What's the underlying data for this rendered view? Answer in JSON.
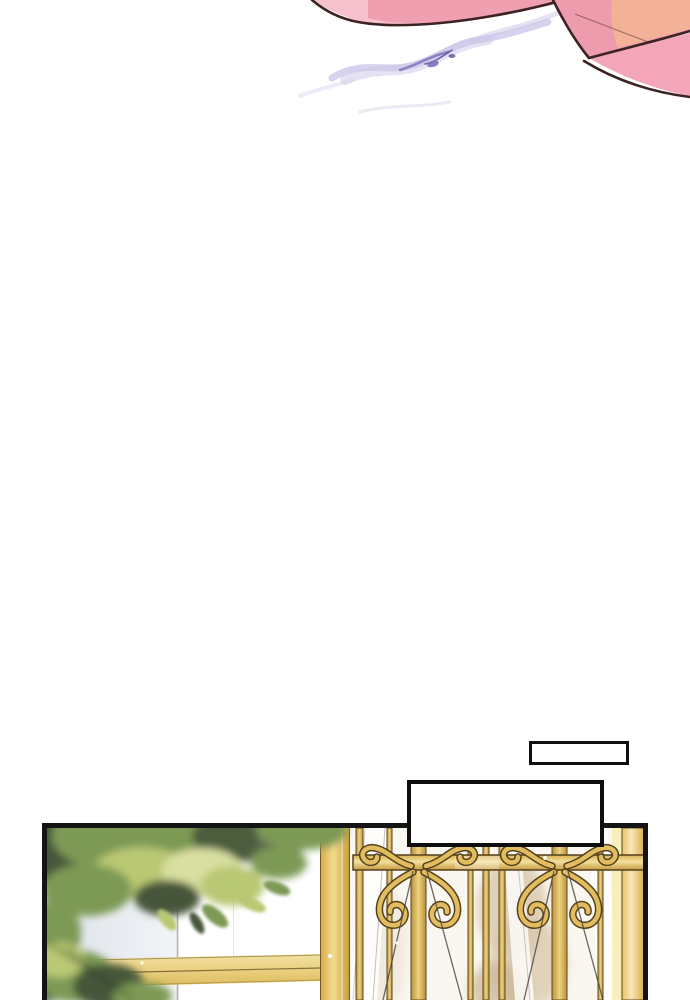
{
  "page": {
    "background": "#ffffff",
    "kind": "comic-page"
  },
  "palette": {
    "box_border": "#0e0e0e",
    "panel_border": "#141414",
    "outline_dark": "#3a2322",
    "ribbon_light": "#f7c0cd",
    "ribbon_rose": "#ee9bad",
    "ribbon_salmon": "#f2b397",
    "ribbon_band": "#f2a6b8",
    "smoke_light": "#cdc5ea",
    "smoke_mid": "#a79bd6",
    "smoke_dark": "#7a6bb4",
    "wall_blue": "#dde3ea",
    "leaf_dark": "#46573a",
    "leaf_mid": "#7d9a55",
    "leaf_light": "#b9c873",
    "leaf_pale": "#d9dfa0",
    "gold_mid": "#e2bd5f",
    "gold_line": "#5d4720",
    "marble": "#d8c6aa",
    "drape_line": "#b5afa6",
    "cord_dark": "#4a4238"
  },
  "top_scene": {
    "elements": [
      "pink-ribbon-bow",
      "magic-smoke-wisp"
    ]
  },
  "speech_boxes": [
    {
      "text": ""
    },
    {
      "text": ""
    }
  ],
  "panel_scene": {
    "elements": [
      "foliage",
      "garden-wall",
      "golden-rail",
      "golden-post",
      "golden-gate",
      "marble-wall",
      "white-drapes"
    ]
  }
}
